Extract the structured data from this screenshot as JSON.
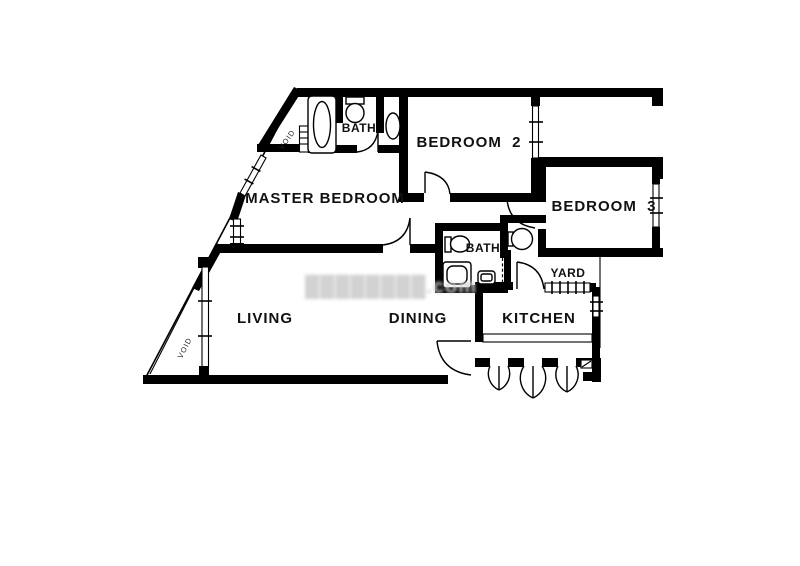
{
  "plan": {
    "type": "apartment-floor-plan",
    "rooms": {
      "master_bedroom": {
        "label": "MASTER BEDROOM"
      },
      "bedroom2": {
        "label": "BEDROOM  2"
      },
      "bedroom3": {
        "label": "BEDROOM  3"
      },
      "bath_top": {
        "label": "BATH"
      },
      "bath_mid": {
        "label": "BATH"
      },
      "yard": {
        "label": "YARD"
      },
      "kitchen": {
        "label": "KITCHEN"
      },
      "living": {
        "label": "LIVING"
      },
      "dining": {
        "label": "DINING"
      },
      "void_upper": {
        "label": "VOID"
      },
      "void_lower": {
        "label": "VOID"
      }
    },
    "watermark": {
      "text": "████████.com"
    },
    "colors": {
      "wall": "#000000",
      "background": "#ffffff",
      "watermark": "#d2d2d2"
    }
  }
}
